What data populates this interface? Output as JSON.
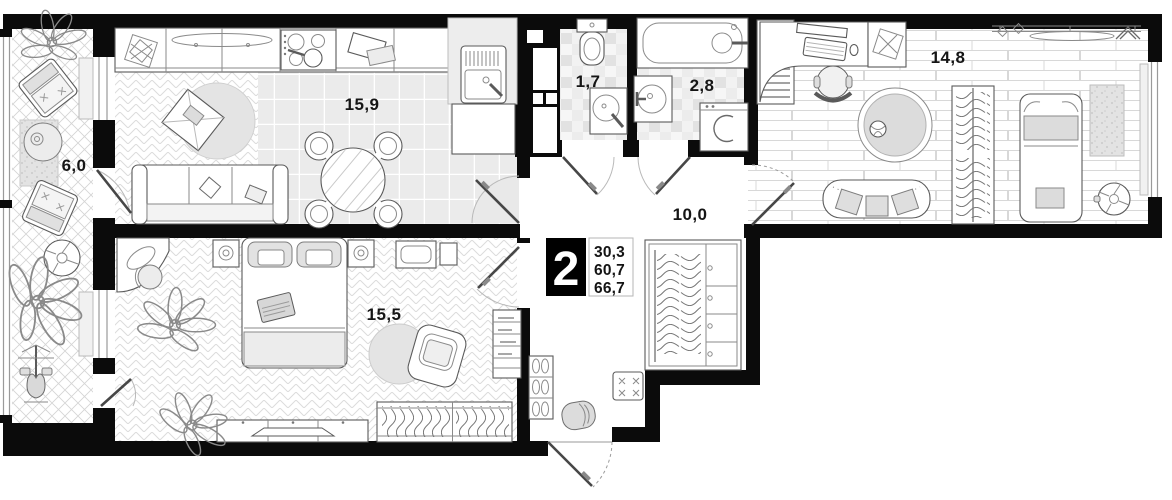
{
  "plan": {
    "badge": {
      "rooms_count": "2",
      "area_living": "30,3",
      "area_main": "60,7",
      "area_total": "66,7"
    },
    "rooms": {
      "balcony": "6,0",
      "kitchen_living": "15,9",
      "wc": "1,7",
      "bathroom": "2,8",
      "bedroom_right": "14,8",
      "hallway": "10,0",
      "bedroom": "15,5"
    },
    "colors": {
      "wall": "#0b0b0b",
      "floor_line": "#dadada",
      "rug_fill": "#e2e2e2",
      "badge_bg": "#000000"
    }
  }
}
